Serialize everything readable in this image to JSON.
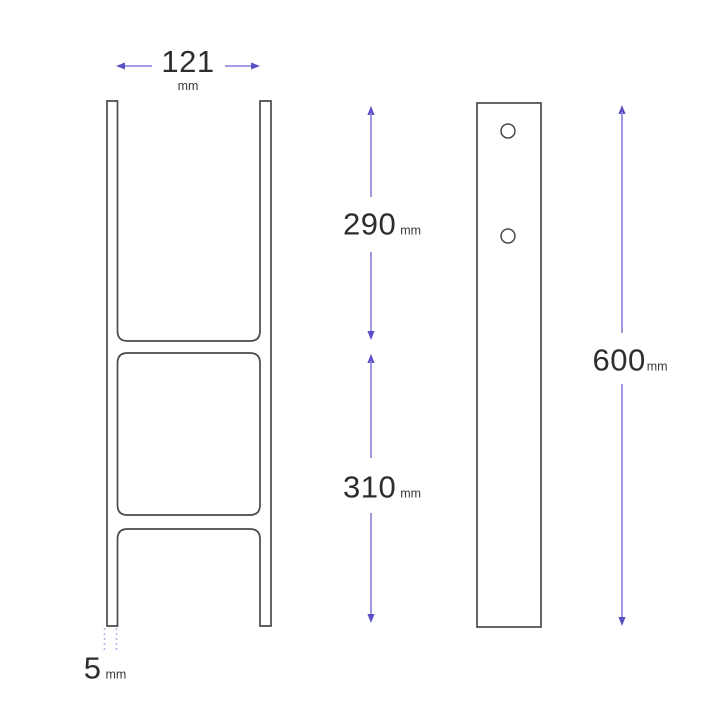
{
  "dimensions": {
    "width": {
      "value": "121",
      "unit": "mm"
    },
    "upper": {
      "value": "290",
      "unit": "mm"
    },
    "lower": {
      "value": "310",
      "unit": "mm"
    },
    "height": {
      "value": "600",
      "unit": "mm"
    },
    "thickness": {
      "value": "5",
      "unit": "mm"
    }
  },
  "colors": {
    "line": "#4a4a4a",
    "text": "#2d2d2d",
    "arrow": "#948ede",
    "arrow_head": "#5b50c6",
    "dotted": "#b9b5e6",
    "background": "#ffffff"
  }
}
